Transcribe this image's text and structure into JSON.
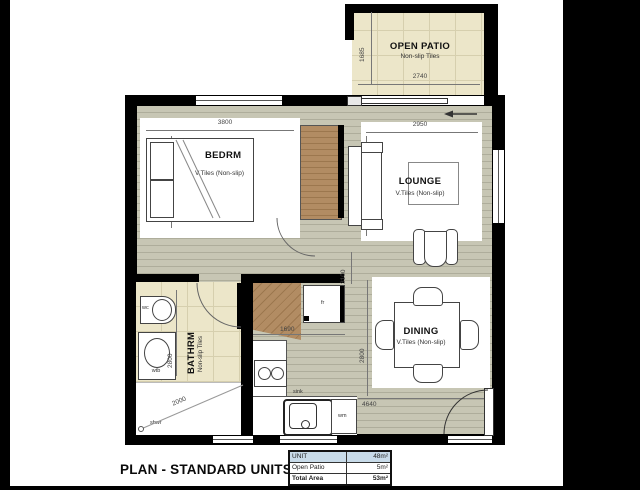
{
  "title": "PLAN - STANDARD UNITS",
  "area_table": {
    "rows": [
      {
        "label": "UNIT",
        "value": "48m²"
      },
      {
        "label": "Open Patio",
        "value": "5m²"
      },
      {
        "label": "Total Area",
        "value": "53m²"
      }
    ]
  },
  "rooms": {
    "open_patio": {
      "name": "OPEN PATIO",
      "finish": "Non-slip Tiles",
      "dim_width": "2740",
      "dim_depth": "1685"
    },
    "bedroom": {
      "name": "BEDRM",
      "finish": "V.Tiles (Non-slip)",
      "dim_width": "3800",
      "dim_depth": "3300"
    },
    "lounge": {
      "name": "LOUNGE",
      "finish": "V.Tiles (Non-slip)",
      "dim_width": "2950",
      "dim_depth": "3300"
    },
    "bathroom": {
      "name": "BATHRM",
      "finish": "Non-slip Tiles",
      "dim_depth": "2800",
      "dim_shower": "2000"
    },
    "kitchen": {
      "dim_counter": "1690",
      "dim_passage": "3100"
    },
    "dining": {
      "name": "DINING",
      "finish": "V.Tiles (Non-slip)",
      "dim_width": "4640",
      "dim_depth": "2800"
    }
  },
  "fixtures": {
    "toilet": "wc",
    "basin": "wtb",
    "shower": "shwr",
    "fridge": "fr",
    "sink": "sink",
    "washing_machine": "wm"
  },
  "colors": {
    "wall": "#000000",
    "tile": "#ece6c9",
    "tile_line": "#d6cfae",
    "floor": "#c7c6b4",
    "wood": "#b28c63",
    "table_header_bg": "#c8dbe9"
  }
}
